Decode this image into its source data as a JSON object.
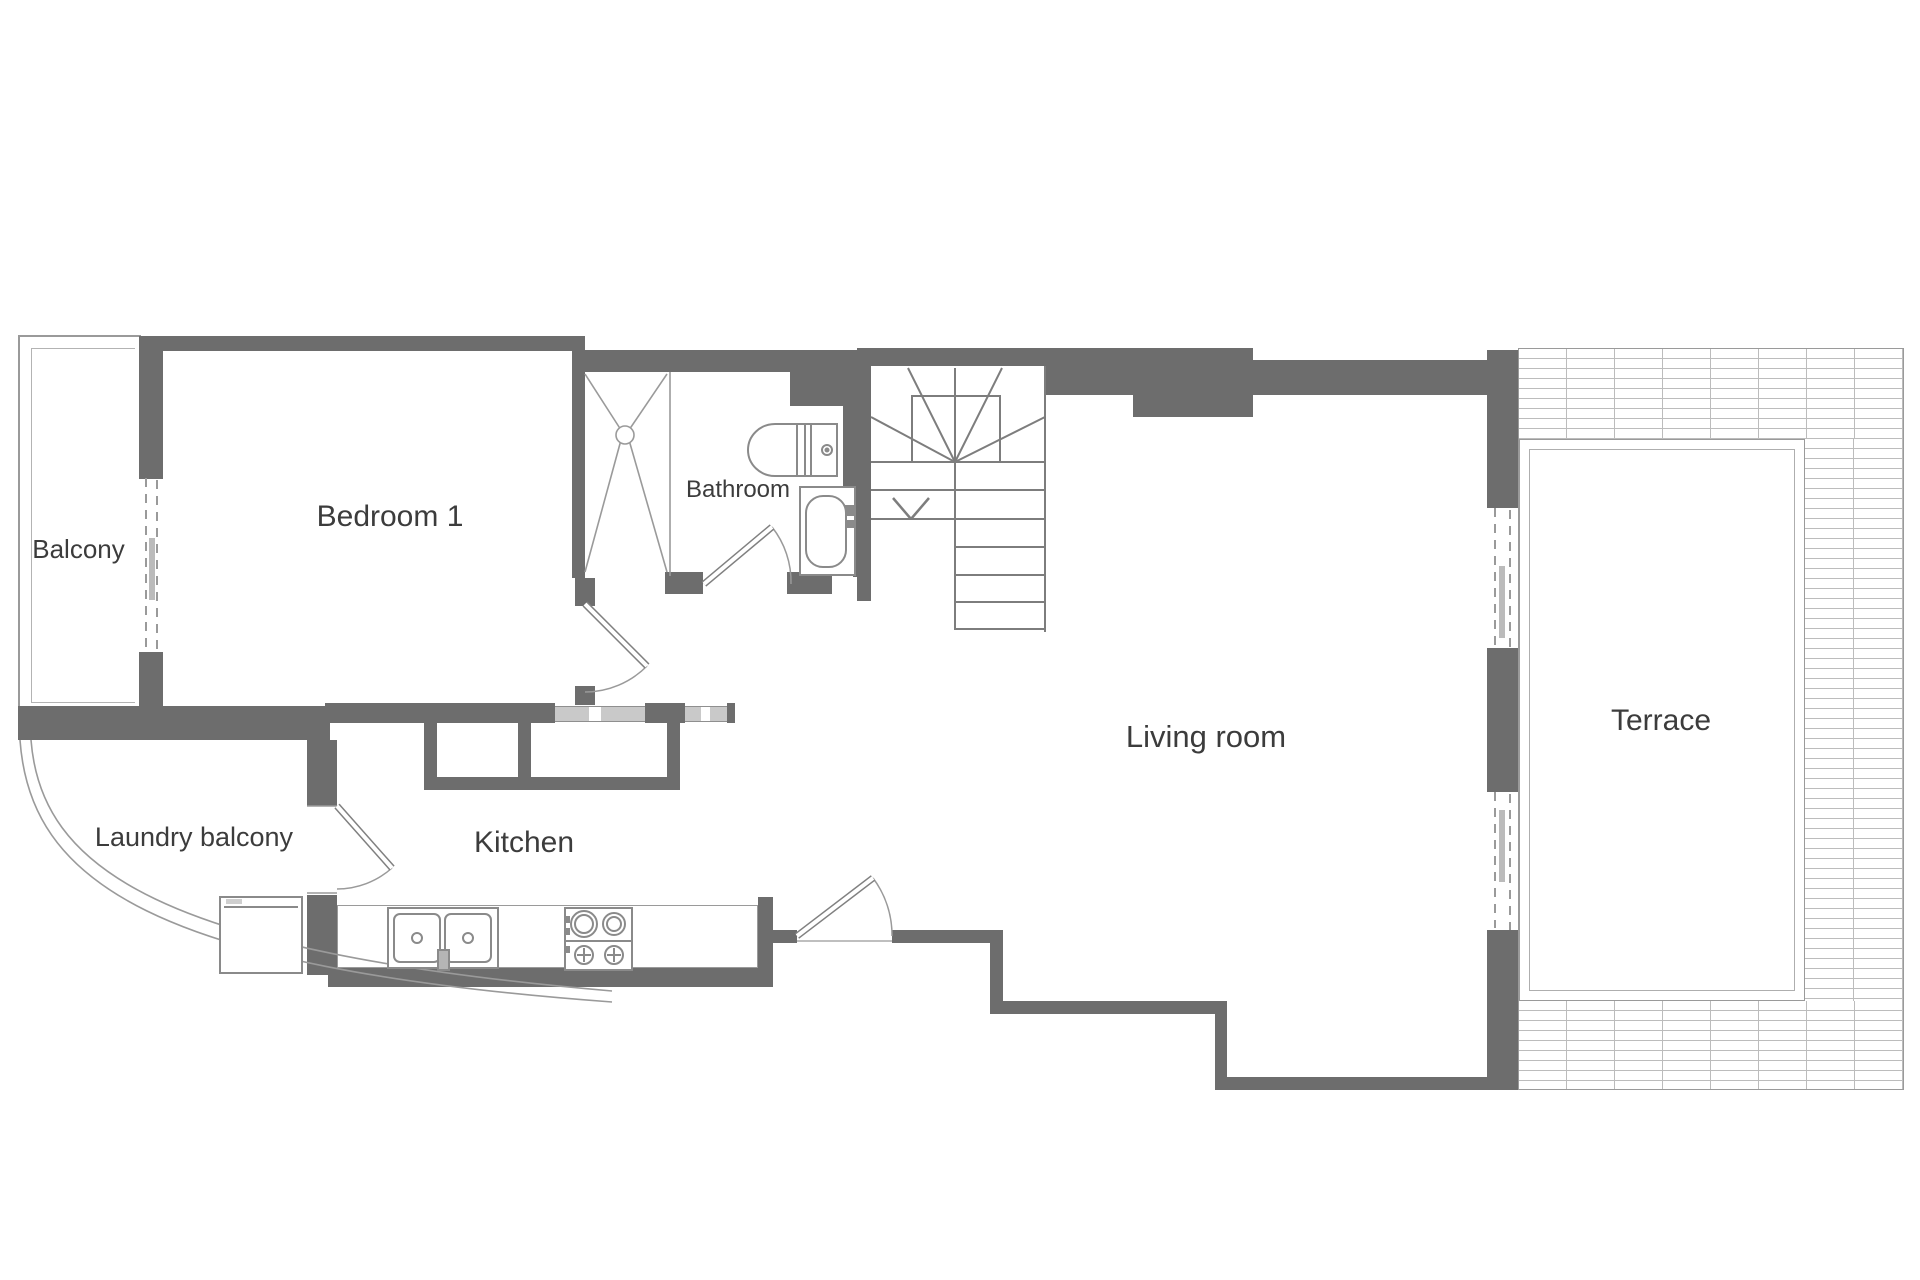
{
  "plan": {
    "kind": "apartment floor plan",
    "rooms": {
      "balcony": {
        "label": "Balcony"
      },
      "bedroom1": {
        "label": "Bedroom 1"
      },
      "bathroom": {
        "label": "Bathroom"
      },
      "kitchen": {
        "label": "Kitchen"
      },
      "laundry_balcony": {
        "label": "Laundry balcony"
      },
      "living_room": {
        "label": "Living room"
      },
      "terrace": {
        "label": "Terrace"
      }
    },
    "fixtures": {
      "shower": "shower-tray-with-cross",
      "toilet": "toilet",
      "bathtub": "bathtub",
      "kitchen_sink": "double-basin-sink",
      "stove": "four-burner-stove",
      "washing_machine": "washing-machine",
      "stairs": {
        "icon": "staircase",
        "direction_arrow": "down"
      }
    },
    "openings": {
      "doors": [
        "bedroom-door",
        "bathroom-door",
        "laundry-balcony-door",
        "entrance-door"
      ],
      "sliding_doors": [
        "balcony-slider",
        "terrace-slider-upper",
        "terrace-slider-lower"
      ]
    },
    "colors": {
      "wall": "#6d6d6d",
      "thin_line": "#9a9a9a",
      "tile_line": "#bcbcbc",
      "window_fill": "#c9c9c9",
      "text": "#3c3c3c",
      "background": "#ffffff"
    }
  }
}
